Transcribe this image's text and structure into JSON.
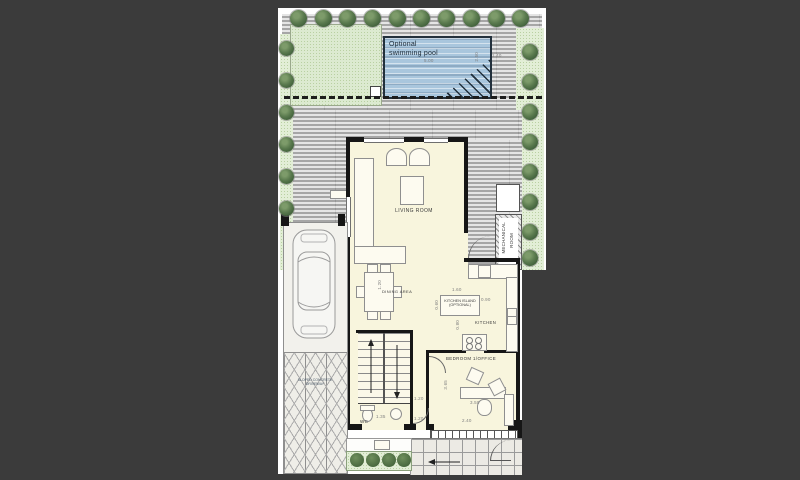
{
  "plan": {
    "pool": {
      "label_line1": "Optional",
      "label_line2": "swimming pool",
      "width": "5.00",
      "depth": "2.50"
    },
    "site": {
      "walk_dim": "1.40",
      "side_dim": "8.75"
    },
    "rooms": {
      "living": "LIVING ROOM",
      "dining": {
        "label": "DINING AREA",
        "dim": "1.20"
      },
      "island": {
        "line1": "KITCHEN ISLAND",
        "line2": "(OPTIONAL)",
        "w": "1.60",
        "d": "0.90",
        "c1": "0.60",
        "c2": "0.80"
      },
      "kitchen": "KITCHEN",
      "mech": {
        "line1": "MECHANICAL",
        "line2": "ROOM"
      },
      "bedroom": {
        "label": "BEDROOM 1/OFFICE",
        "depth": "3.65",
        "desk": "3.50",
        "width": "2.40"
      },
      "wc": {
        "label": "WC",
        "dim": "1.35"
      },
      "hall": {
        "dim_a": "1.20",
        "dim_b": "1.20"
      }
    },
    "driveway": {
      "line1": "SLOPED CONCRETE",
      "line2": "DRIVEWAY"
    }
  }
}
